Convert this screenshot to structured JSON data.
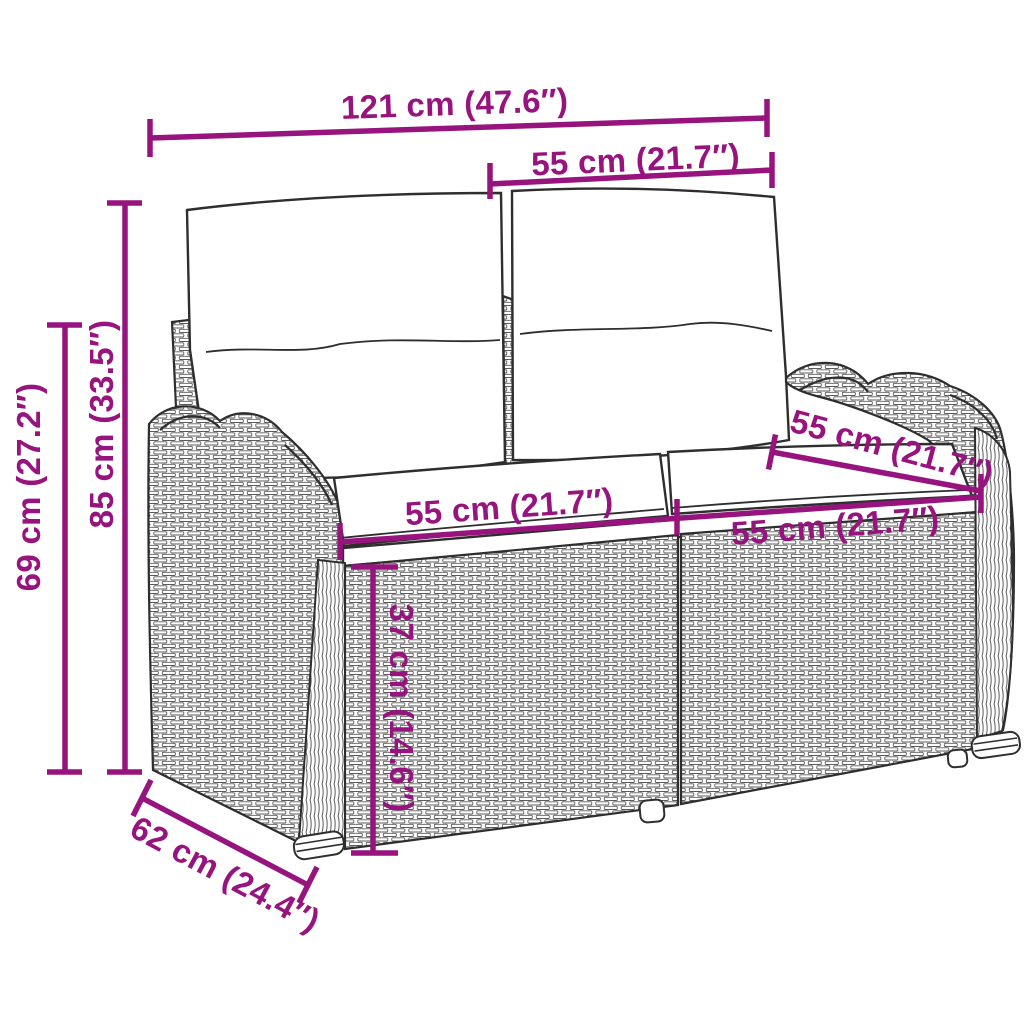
{
  "figure": {
    "accent_color": "#97137D",
    "line_art_color": "#2E2E2E"
  },
  "dimensions": {
    "overall_width": "121 cm (47.6″)",
    "backrest_top_width": "55 cm (21.7″)",
    "total_height": "85 cm (33.5″)",
    "side_height": "69 cm (27.2″)",
    "seat_width_left": "55 cm (21.7″)",
    "seat_width_right": "55 cm (21.7″)",
    "seat_depth": "55 cm (21.7″)",
    "seat_height": "37 cm (14.6″)",
    "depth": "62 cm (24.4″)"
  }
}
